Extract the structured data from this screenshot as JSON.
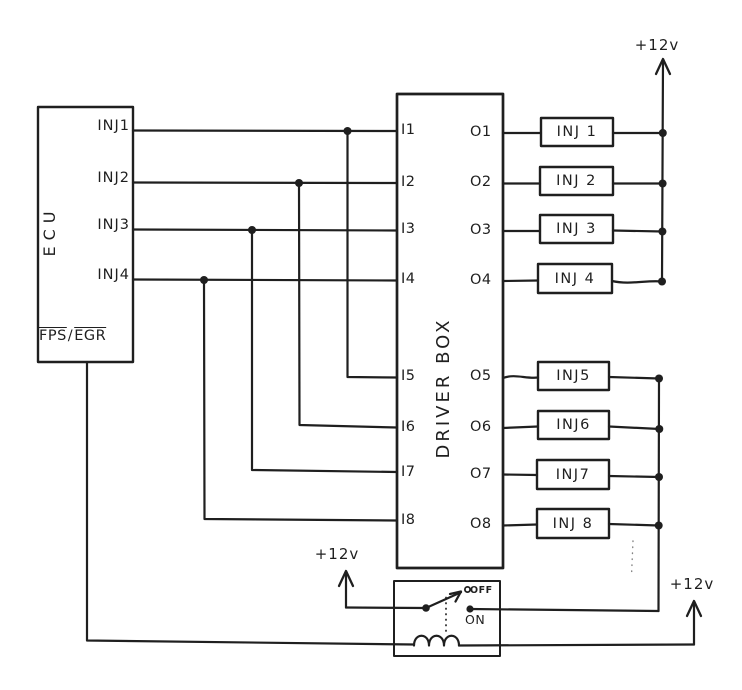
{
  "ecu": {
    "label": "ECU",
    "pins": [
      "INJ1",
      "INJ2",
      "INJ3",
      "INJ4"
    ],
    "fps": "FPS",
    "slash": "/",
    "egr": "EGR"
  },
  "driver_box": {
    "label": "DRIVER BOX",
    "inputs": [
      "I1",
      "I2",
      "I3",
      "I4",
      "I5",
      "I6",
      "I7",
      "I8"
    ],
    "outputs": [
      "O1",
      "O2",
      "O3",
      "O4",
      "O5",
      "O6",
      "O7",
      "O8"
    ]
  },
  "injectors": [
    "INJ 1",
    "INJ 2",
    "INJ 3",
    "INJ 4",
    "INJ5",
    "INJ6",
    "INJ7",
    "INJ 8"
  ],
  "power": {
    "rail_top": "+12v",
    "switch_feed": "+12v",
    "coil_feed": "+12v"
  },
  "relay": {
    "off": "OFF",
    "on": "ON"
  },
  "colors": {
    "ink": "#1f1f1f",
    "paper": "#ffffff"
  }
}
